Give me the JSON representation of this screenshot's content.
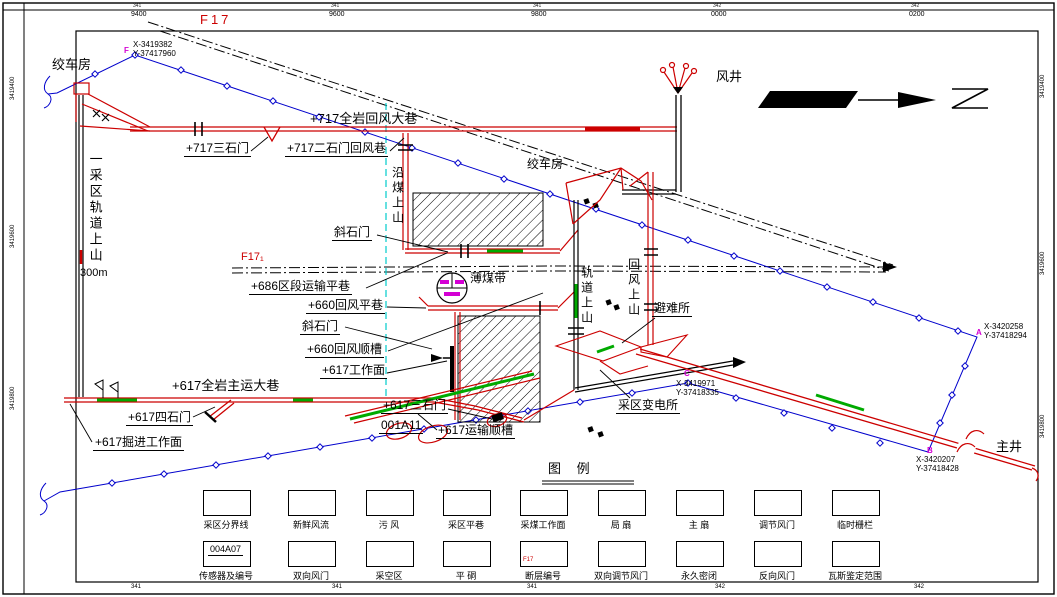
{
  "frame": {
    "top_minor": [
      "341",
      "341",
      "341",
      "342",
      "342"
    ],
    "top": [
      "9400",
      "9600",
      "9800",
      "0000",
      "0200"
    ],
    "bottom": [
      "341",
      "341",
      "341",
      "342",
      "342"
    ],
    "left": [
      "3419400",
      "3419600",
      "3419800"
    ],
    "right": [
      "3419400",
      "3419600",
      "3419800"
    ]
  },
  "faults": {
    "f17": "F17",
    "f17_1": "F17₁"
  },
  "labels": {
    "winch_left": "绞车房",
    "winch_right": "绞车房",
    "wind_shaft": "风井",
    "main_shaft": "主井",
    "q717_main": "+717全岩回风大巷",
    "q717_s3": "+717三石门",
    "q717_s2": "+717二石门回风巷",
    "left_incline": "一采区轨道上山",
    "left_incline_len": "300m",
    "coal_incline": "沿煤上山",
    "xsm_upper": "斜石门",
    "q686": "+686区段运输平巷",
    "thin_coal": "薄煤带",
    "q660_level": "+660回风平巷",
    "xsm_lower": "斜石门",
    "q660_gate": "+660回风顺槽",
    "q617_face": "+617工作面",
    "q617_main": "+617全岩主运大巷",
    "q617_s3": "+617三石门",
    "panel_id": "001A11",
    "q617_gate": "+617运输顺槽",
    "q617_s4": "+617四石门",
    "q617_dev": "+617掘进工作面",
    "track_incline": "轨道上山",
    "return_incline": "回风上山",
    "refuge": "避难所",
    "substation": "采区变电所"
  },
  "survey": {
    "F": {
      "id": "F",
      "x": "X-3419382",
      "y": "Y-37417960"
    },
    "A": {
      "id": "A",
      "x": "X-3420258",
      "y": "Y-37418294"
    },
    "B": {
      "id": "B",
      "x": "X-3420207",
      "y": "Y-37418428"
    },
    "C": {
      "id": "C",
      "x": "X-3419971",
      "y": "Y-37418335"
    }
  },
  "legend": {
    "title": "图    例",
    "row1": [
      "采区分界线",
      "新鲜风流",
      "污  风",
      "采区平巷",
      "采煤工作面",
      "局  扇",
      "主  扇",
      "调节风门",
      "临时栅栏"
    ],
    "row2": [
      "传感器及编号",
      "双向风门",
      "采空区",
      "平  硐",
      "断层编号",
      "双向调节风门",
      "永久密闭",
      "反向风门",
      "瓦斯鉴定范围"
    ],
    "sensor_id": "004A07",
    "fault_tag": "F17"
  },
  "colors": {
    "roadway_red": "#cc0000",
    "survey_blue": "#0000cc",
    "boundary_cyan": "#00cccc",
    "fresh_air_green": "#00aa00",
    "marker_magenta": "#d400d4"
  }
}
